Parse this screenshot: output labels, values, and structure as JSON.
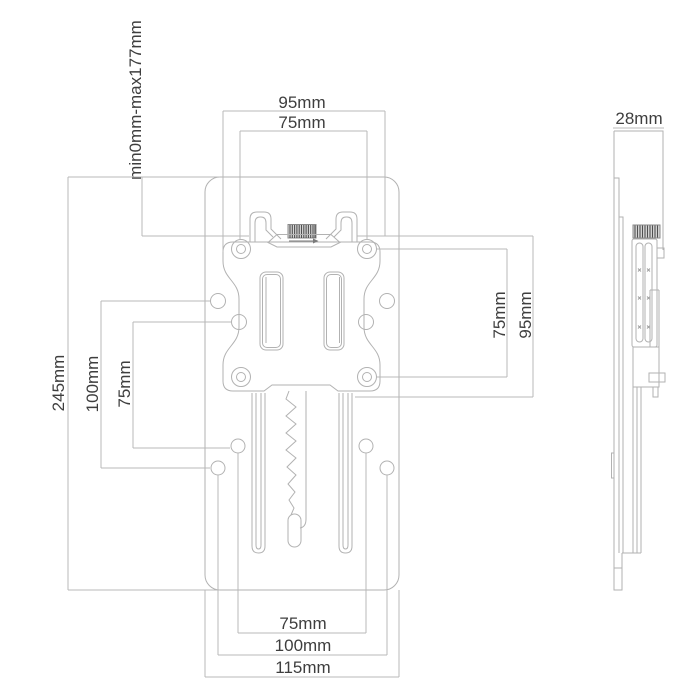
{
  "drawing": {
    "labels": {
      "top_width_outer": "95mm",
      "top_width_inner": "75mm",
      "height_range": "min0mm-max177mm",
      "plate_height": "245mm",
      "left_spacing_100": "100mm",
      "left_spacing_75": "75mm",
      "right_vesa_75": "75mm",
      "right_plate_95": "95mm",
      "bottom_75": "75mm",
      "bottom_100": "100mm",
      "bottom_115": "115mm",
      "side_depth": "28mm"
    },
    "colors": {
      "line": "#b2b2b2",
      "dimension_line": "#b8b8b8",
      "text": "#3e3e3e",
      "knob_hatch": "#4f4f4f",
      "background": "#ffffff"
    }
  }
}
